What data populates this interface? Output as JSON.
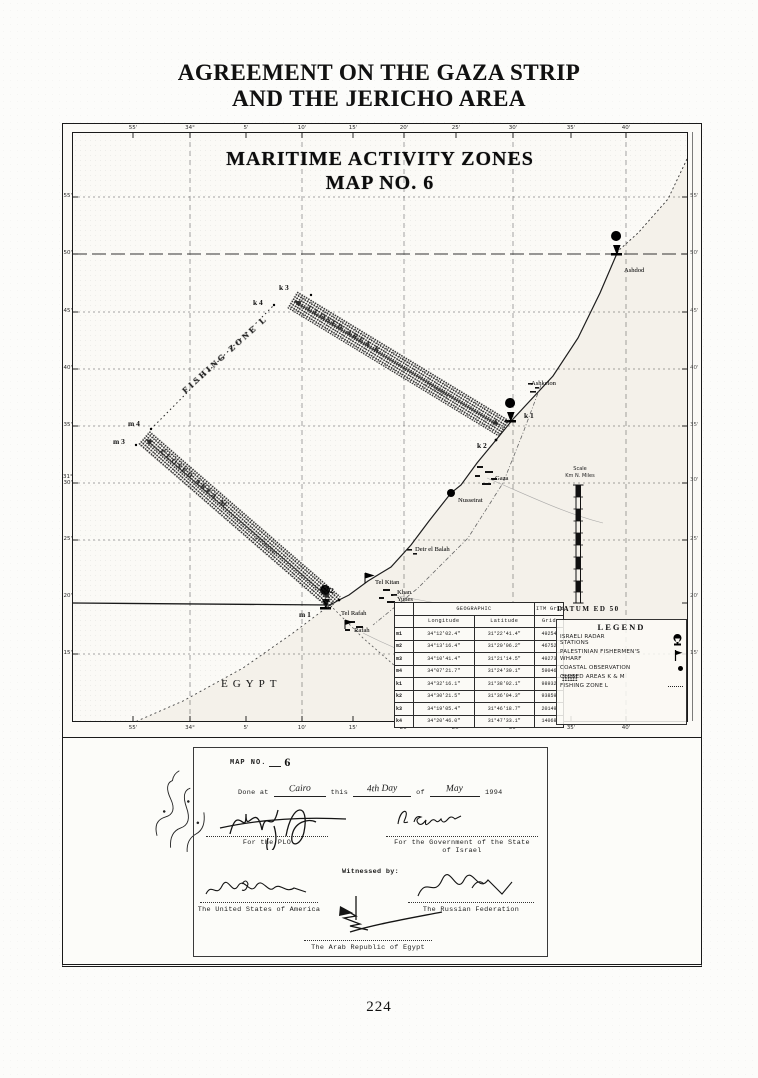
{
  "page": {
    "title1": "AGREEMENT ON THE GAZA STRIP",
    "title2": "AND THE JERICHO AREA",
    "page_number": "224"
  },
  "map": {
    "title1": "MARITIME ACTIVITY ZONES",
    "title2": "MAP NO. 6",
    "datum": "DATUM  ED 50",
    "axis": {
      "top": [
        "55'",
        "34°",
        "5'",
        "10'",
        "15'",
        "20'",
        "25'",
        "30'",
        "35'",
        "40'"
      ],
      "bottom": [
        "55'",
        "34°",
        "5'",
        "10'",
        "15'",
        "20'",
        "25'",
        "30'",
        "35'",
        "40'"
      ],
      "left": [
        "55'",
        "50'",
        "45'",
        "40'",
        "35'",
        "31°\n30'",
        "25'",
        "20'",
        "15'"
      ],
      "right": [
        "55'",
        "50'",
        "45'",
        "40'",
        "35'",
        "30'",
        "25'",
        "20'",
        "15'"
      ]
    },
    "zones": {
      "fishing": "FISHING ZONE L",
      "closed_k": "CLOSED AREA K",
      "closed_m": "CLOSED AREA M",
      "k_miles": "20 miles",
      "m_miles": "20 miles"
    },
    "points": {
      "k1": "k 1",
      "k2": "k 2",
      "k3": "k 3",
      "k4": "k 4",
      "m1": "m 1",
      "m2": "m 2",
      "m3": "m 3",
      "m4": "m 4"
    },
    "places": {
      "ashdod": "Ashdod",
      "ashkelon": "Ashkelon",
      "gaza": "Gaza",
      "nusseirat": "Nusseirat",
      "deir": "Deir el Balah",
      "telkitan": "Tel Kitan",
      "khan": "Khan\nYunes",
      "telrafah": "Tel Rafah",
      "rafah": "Rafah",
      "egypt": "EGYPT"
    },
    "scale": {
      "title": "Scale",
      "units": "Km   N. Miles"
    },
    "table": {
      "geo": "GEOGRAPHIC",
      "itm": "ITM Grid",
      "sub": [
        "Longitude",
        "Latitude",
        "Grid"
      ],
      "rows": [
        {
          "id": "m1",
          "lon": "34°12'02.4\"",
          "lat": "31°22'41.4\"",
          "grid": "49254"
        },
        {
          "id": "m2",
          "lon": "34°13'16.4\"",
          "lat": "31°20'06.2\"",
          "grid": "46752"
        },
        {
          "id": "m3",
          "lon": "34°10'41.4\"",
          "lat": "31°21'14.5\"",
          "grid": "49273"
        },
        {
          "id": "m4",
          "lon": "34°07'21.7\"",
          "lat": "31°24'30.1\"",
          "grid": "59046"
        },
        {
          "id": "k1",
          "lon": "34°32'16.1\"",
          "lat": "31°38'02.1\"",
          "grid": "98932"
        },
        {
          "id": "k2",
          "lon": "34°30'21.5\"",
          "lat": "31°36'04.3\"",
          "grid": "93859"
        },
        {
          "id": "k3",
          "lon": "34°19'05.4\"",
          "lat": "31°46'18.7\"",
          "grid": "20149"
        },
        {
          "id": "k4",
          "lon": "34°20'46.0\"",
          "lat": "31°47'33.1\"",
          "grid": "14068"
        }
      ]
    },
    "legend": {
      "title": "LEGEND",
      "items": [
        {
          "label": "ISRAELI RADAR\nSTATIONS"
        },
        {
          "label": "PALESTINIAN FISHERMEN'S\nWHARF"
        },
        {
          "label": "COASTAL OBSERVATION"
        },
        {
          "label": "CLOSED AREAS  K & M"
        },
        {
          "label": "FISHING ZONE  L"
        }
      ]
    }
  },
  "signatures": {
    "map_no_label": "MAP NO.",
    "map_no_value": "6",
    "done": {
      "done_at": "Done at",
      "place": "Cairo",
      "this": "this",
      "day": "4th Day",
      "of": "of",
      "month": "May",
      "year": "1994"
    },
    "plo": "For the PLO",
    "israel": "For the Government of the State\nof Israel",
    "witnessed": "Witnessed by:",
    "usa": "The United States of America",
    "russia": "The Russian Federation",
    "egypt": "The Arab Republic of Egypt"
  }
}
